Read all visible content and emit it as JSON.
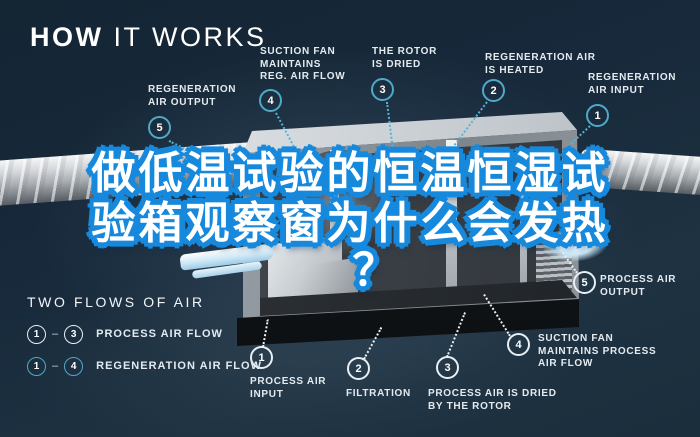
{
  "title": {
    "bold": "HOW",
    "light": " IT WORKS"
  },
  "overlay": {
    "line1": "做低温试验的恒温恒湿试",
    "line2": "验箱观察窗为什么会发热",
    "line3": "？",
    "fill_color": "#ffffff",
    "outline_color": "#1789dd"
  },
  "callouts": {
    "regeneration_color": "#4fa9c8",
    "process_color": "#e9eff3",
    "top": [
      {
        "num": "5",
        "label": "REGENERATION\nAIR OUTPUT"
      },
      {
        "num": "4",
        "label": "SUCTION FAN\nMAINTAINS\nREG. AIR FLOW"
      },
      {
        "num": "3",
        "label": "THE ROTOR\nIS DRIED"
      },
      {
        "num": "2",
        "label": "REGENERATION AIR\nIS HEATED"
      },
      {
        "num": "1",
        "label": "REGENERATION\nAIR INPUT"
      }
    ],
    "bottom": [
      {
        "num": "1",
        "label": "PROCESS AIR\nINPUT"
      },
      {
        "num": "2",
        "label": "FILTRATION"
      },
      {
        "num": "3",
        "label": "PROCESS AIR IS DRIED\nBY THE ROTOR"
      },
      {
        "num": "4",
        "label": "SUCTION FAN\nMAINTAINS PROCESS\nAIR FLOW"
      },
      {
        "num": "5",
        "label": "PROCESS AIR\nOUTPUT"
      }
    ]
  },
  "legend": {
    "heading": "TWO FLOWS OF AIR",
    "dash": "–",
    "rows": [
      {
        "from": "1",
        "to": "3",
        "label": "PROCESS AIR FLOW",
        "color": "#ffffff"
      },
      {
        "from": "1",
        "to": "4",
        "label": "REGENERATION AIR FLOW",
        "color": "#4fa9c8"
      }
    ]
  },
  "colors": {
    "background": "#17293a",
    "accent_cyan": "#4fa9c8",
    "metal_light": "#eef0f2",
    "metal_dark": "#565c62"
  }
}
